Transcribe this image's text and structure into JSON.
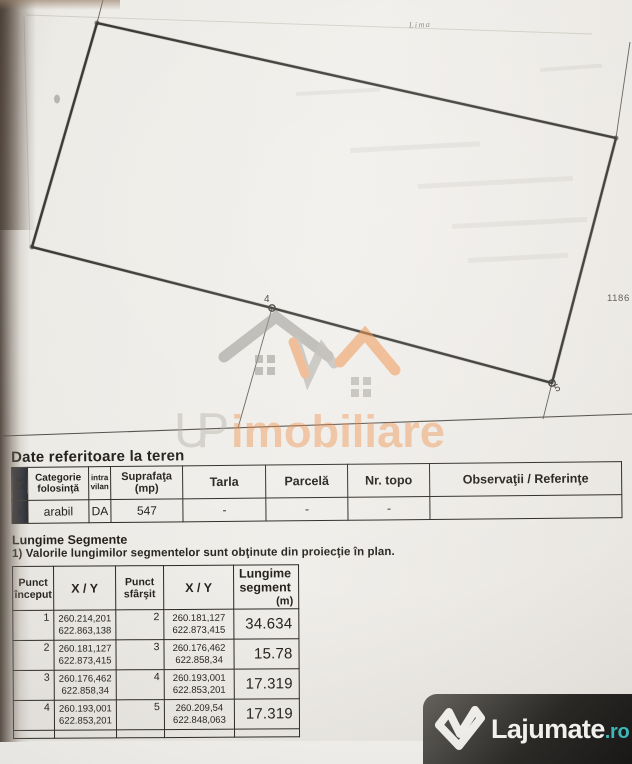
{
  "plan": {
    "point_labels": {
      "p4": "4",
      "p5": "5"
    },
    "notes": {
      "handwriting": "Lima",
      "right": "1186"
    }
  },
  "watermark": {
    "prefix": "UP",
    "name": "imobiliare"
  },
  "teren": {
    "title": "Date referitoare la teren",
    "headers": [
      "Nr Crt",
      "Categorie folosinţă",
      "intra vilan",
      "Suprafaţa (mp)",
      "Tarla",
      "Parcelă",
      "Nr. topo",
      "Observaţii / Referinţe"
    ],
    "row": [
      "1",
      "arabil",
      "DA",
      "547",
      "-",
      "-",
      "-",
      ""
    ]
  },
  "segmente": {
    "title": "Lungime Segmente",
    "note": "1) Valorile lungimilor segmentelor sunt obţinute din proiecţie în plan.",
    "headers": {
      "start": "Punct început",
      "xy": "X / Y",
      "end": "Punct sfârşit",
      "xy2": "X / Y",
      "length": "Lungime segment",
      "unit": "(m)"
    },
    "rows": [
      {
        "s": "1",
        "sx": "260.214,201",
        "sy": "622.863,138",
        "e": "2",
        "ex": "260.181,127",
        "ey": "622.873,415",
        "len": "34.634"
      },
      {
        "s": "2",
        "sx": "260.181,127",
        "sy": "622.873,415",
        "e": "3",
        "ex": "260.176,462",
        "ey": "622.858,34",
        "len": "15.78"
      },
      {
        "s": "3",
        "sx": "260.176,462",
        "sy": "622.858,34",
        "e": "4",
        "ex": "260.193,001",
        "ey": "622.853,201",
        "len": "17.319"
      },
      {
        "s": "4",
        "sx": "260.193,001",
        "sy": "622.853,201",
        "e": "5",
        "ex": "260.209,54",
        "ey": "622.848,063",
        "len": "17.319"
      }
    ]
  },
  "logo": {
    "brand": "Lajumate",
    "tld": ".ro"
  },
  "colors": {
    "watermark_orange": "#ee8a3f",
    "watermark_gray": "#a09c95",
    "logo_teal": "#3abfbf",
    "ink": "#32302b",
    "dark_cell": "#262b33"
  }
}
